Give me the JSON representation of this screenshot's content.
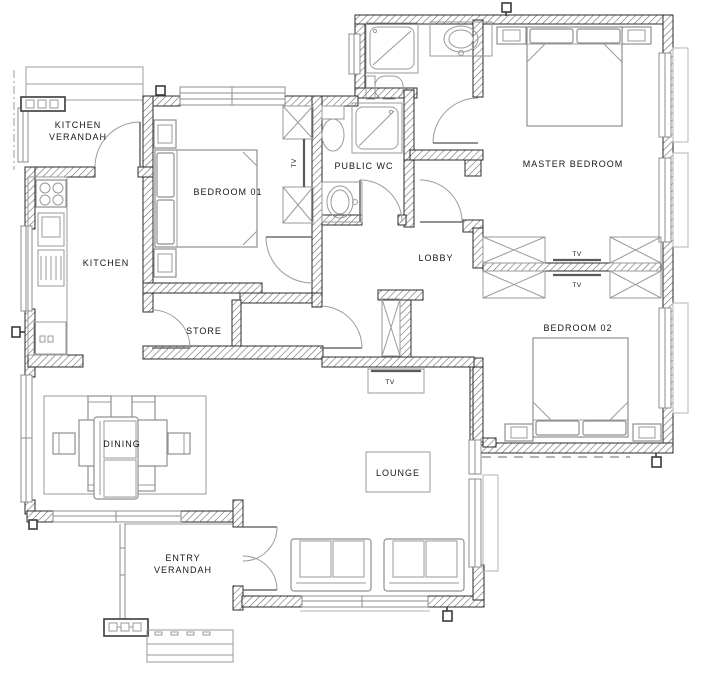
{
  "plan": {
    "type": "residential-floor-plan",
    "rooms": {
      "kitchen_verandah": {
        "line1": "KITCHEN",
        "line2": "VERANDAH"
      },
      "bedroom_01": {
        "label": "BEDROOM 01"
      },
      "public_wc": {
        "label": "PUBLIC WC"
      },
      "master_bedroom": {
        "label": "MASTER BEDROOM"
      },
      "kitchen": {
        "label": "KITCHEN"
      },
      "lobby": {
        "label": "LOBBY"
      },
      "store": {
        "label": "STORE"
      },
      "bedroom_02": {
        "label": "BEDROOM 02"
      },
      "dining": {
        "label": "DINING"
      },
      "lounge": {
        "label": "LOUNGE"
      },
      "entry_verandah": {
        "line1": "ENTRY",
        "line2": "VERANDAH"
      }
    },
    "fixtures": {
      "tv_label": "TV"
    },
    "colors": {
      "wall_stroke": "#2b2b2b",
      "hatch_line": "#6b6b6b",
      "furniture": "#8f8f8f",
      "text": "#161616",
      "background": "#ffffff"
    }
  }
}
